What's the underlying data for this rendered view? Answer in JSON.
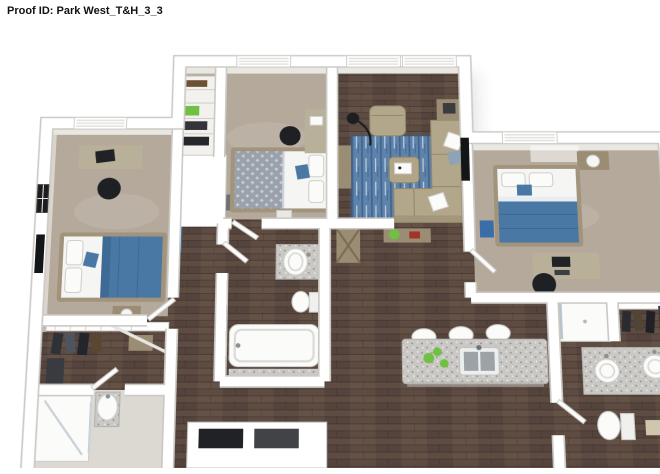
{
  "header": {
    "proof_id": "Proof ID: Park West_T&H_3_3"
  },
  "palette": {
    "wall": "#ffffff",
    "wall-edge": "#cbc9c4",
    "carpet": "#b4a99b",
    "wood": "#5e4c43",
    "wood-light": "#76614f",
    "wood-dark": "#453630",
    "rug": "#5d83ab",
    "rug-dark": "#3f618b",
    "duvet": "#4a78a4",
    "duvet-dark": "#39658f",
    "linen": "#f5f5f3",
    "sofa": "#b2a68b",
    "sofa-dark": "#93876c",
    "bedframe": "#a2947c",
    "granite": "#c9c8c4",
    "green": "#6fc043",
    "tile": "#dcd9d3",
    "steel": "#212226",
    "furn-wood": "#9b8d74"
  },
  "floorplan": {
    "style": "3d-dollhouse-render",
    "bedrooms": 3,
    "bathrooms": 3,
    "rooms": [
      {
        "name": "bedroom-1",
        "floor": "carpet",
        "furniture": [
          "desk with laptop",
          "office chair",
          "bed with blue duvet",
          "nightstand with lamp",
          "wall tv",
          "window"
        ]
      },
      {
        "name": "bedroom-2",
        "floor": "carpet",
        "furniture": [
          "bed with gray patterned duvet",
          "desk",
          "office chair",
          "bench",
          "window",
          "reach-in closet"
        ]
      },
      {
        "name": "bedroom-3",
        "floor": "carpet",
        "furniture": [
          "bed with blue duvet",
          "nightstand with lamp",
          "desk with monitor",
          "office chair",
          "wall tv",
          "window"
        ]
      },
      {
        "name": "living-room",
        "floor": "wood",
        "furniture": [
          "sectional sofa",
          "armchair",
          "ottoman tray table",
          "end table",
          "console",
          "arc floor lamp",
          "blue area rug",
          "wall tv",
          "double window"
        ]
      },
      {
        "name": "kitchen",
        "floor": "wood",
        "furniture": [
          "granite island with sink",
          "3 bar stools",
          "fruit decor",
          "base cabinets"
        ]
      },
      {
        "name": "bathroom-1",
        "floor": "wood",
        "furniture": [
          "granite vanity sink",
          "toilet",
          "bathtub"
        ]
      },
      {
        "name": "bathroom-2",
        "floor": "wood",
        "furniture": [
          "double granite vanity",
          "toilet",
          "shower",
          "towel"
        ]
      },
      {
        "name": "bathroom-3",
        "floor": "tile",
        "furniture": [
          "glass shower",
          "pedestal sink"
        ]
      },
      {
        "name": "walk-in-closet",
        "floor": "wood",
        "furniture": [
          "wire shelving",
          "hanging clothes"
        ]
      }
    ]
  }
}
